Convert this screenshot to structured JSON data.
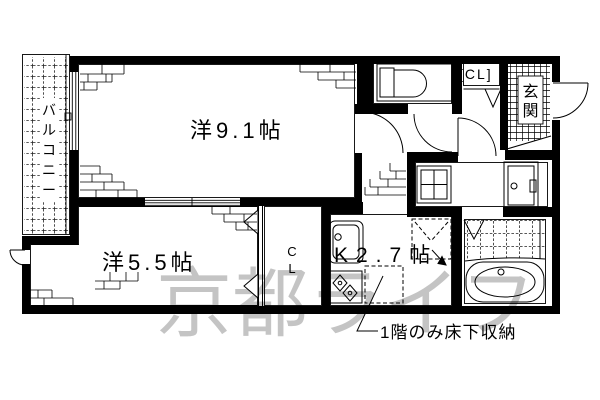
{
  "plan": {
    "rooms": {
      "large_room": {
        "label": "洋9.1帖"
      },
      "small_room": {
        "label": "洋5.5帖"
      },
      "kitchen": {
        "label": "K2.7帖"
      },
      "closet_hall": {
        "label": "[CL]"
      },
      "closet_small_room": {
        "chars": [
          "C",
          "L"
        ]
      },
      "balcony": {
        "label": "バルコニー",
        "chars": [
          "バ",
          "ル",
          "コ",
          "ニ",
          "ー"
        ]
      },
      "entrance": {
        "label": "玄関",
        "chars": [
          "玄",
          "関"
        ]
      }
    },
    "annotations": {
      "underfloor_note": "1階のみ床下収納",
      "watermark": "京都ライフ"
    },
    "colors": {
      "line": "#000000",
      "watermark": "#c4c4c4",
      "background": "#ffffff"
    }
  }
}
